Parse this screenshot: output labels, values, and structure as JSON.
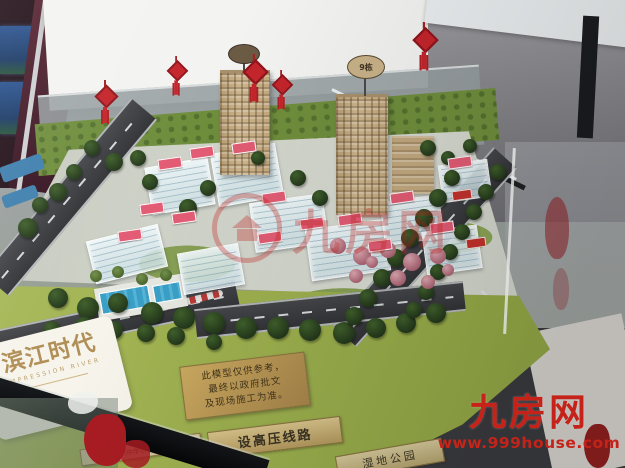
{
  "nameplate": {
    "title": "滨江时代",
    "subtitle": "IMPRESSION RIVER"
  },
  "disclaimer": {
    "line1": "此模型仅供参考，",
    "line2": "最终以政府批文",
    "line3": "及现场施工为准。"
  },
  "signs": {
    "power_line": "设高压线路",
    "wetland_park": "湿地公园",
    "surroundings": "周边配套（中学小学）（规划中）",
    "tower_b_number": "9栋"
  },
  "watermarks": {
    "center_brand": "九房网",
    "corner_brand": "九房网",
    "corner_url": "www.999house.com",
    "red": "#e0271c"
  },
  "colors": {
    "lawn_green": "#9cb052",
    "base_green": "#6f8e3c",
    "road_gray": "#3c3c40",
    "plaque_gold": "#b5935a",
    "tower_tan": "#c7ae87",
    "label_pink": "#e25c74"
  }
}
